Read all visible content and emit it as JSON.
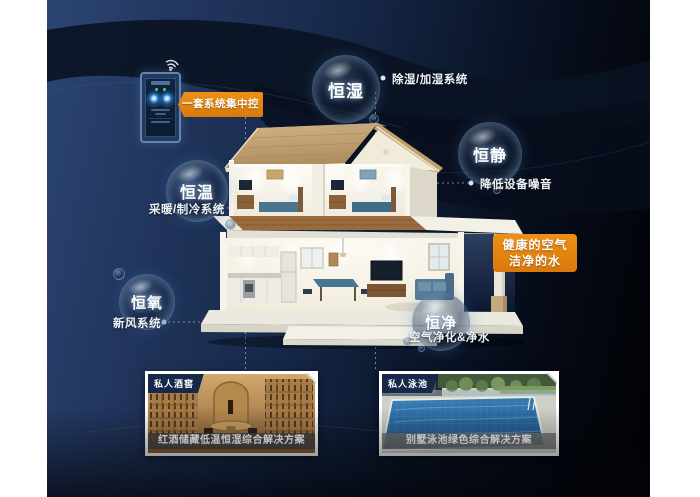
{
  "panel": {
    "control_badge": "一套系统集中控制",
    "healthy_badge_line1": "健康的空气",
    "healthy_badge_line2": "洁净的水"
  },
  "features": [
    {
      "name": "恒湿",
      "system": "除湿/加湿系统"
    },
    {
      "name": "恒静",
      "system": "降低设备噪音"
    },
    {
      "name": "恒温",
      "system": "采暖/制冷系统"
    },
    {
      "name": "恒氧",
      "system": "新风系统"
    },
    {
      "name": "恒净",
      "system": "空气净化&净水"
    }
  ],
  "cards": [
    {
      "tag": "私人酒窖",
      "caption": "红酒储藏低温恒湿综合解决方案"
    },
    {
      "tag": "私人泳池",
      "caption": "别墅泳池绿色综合解决方案"
    }
  ],
  "colors": {
    "accent_orange": "#e1820e",
    "panel_navy": "#1d3156",
    "bubble_glow": "#a9cdea"
  },
  "icons": {
    "wifi": "wifi-icon"
  }
}
